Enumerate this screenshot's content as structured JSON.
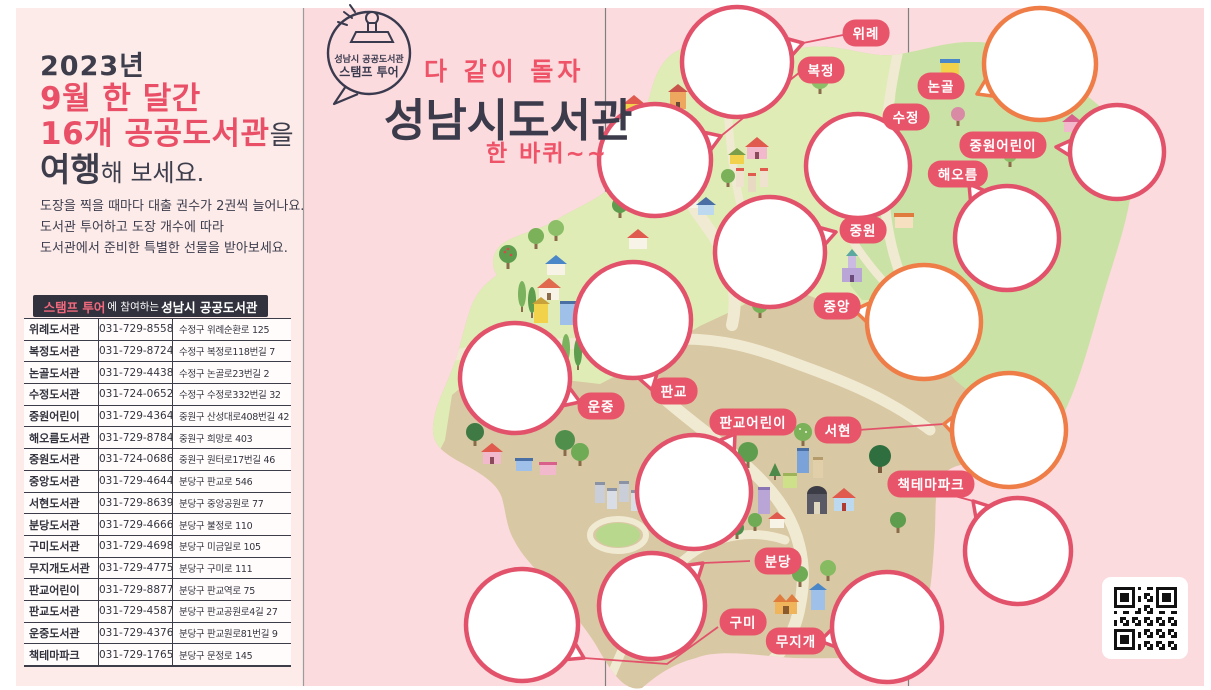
{
  "brochure": {
    "badge": {
      "org": "성남시 공공도서관",
      "tour": "스탬프 투어"
    },
    "tagline": "다 같이 돌자",
    "title": "성남시도서관",
    "subtitle": "한 바퀴~~"
  },
  "left_panel": {
    "heading": {
      "year": "2023년",
      "line2": "9월 한 달간",
      "line3_accent": "16개 공공도서관",
      "line3_suffix": "을",
      "line4_strong": "여행",
      "line4_suffix": "해 보세요."
    },
    "description_lines": [
      "도장을 찍을 때마다 대출 권수가 2권씩 늘어나요.",
      "도서관 투어하고 도장 개수에 따라",
      "도서관에서 준비한 특별한 선물을 받아보세요."
    ],
    "table": {
      "title_accent": "스탬프 투어",
      "title_middle": "에 참여하는",
      "title_strong": "성남시 공공도서관",
      "rows": [
        {
          "name": "위례도서관",
          "phone": "031-729-8558",
          "address": "수정구 위례순환로 125"
        },
        {
          "name": "복정도서관",
          "phone": "031-729-8724",
          "address": "수정구 복정로118번길 7"
        },
        {
          "name": "논골도서관",
          "phone": "031-729-4438",
          "address": "수정구 논골로23번길 2"
        },
        {
          "name": "수정도서관",
          "phone": "031-724-0652",
          "address": "수정구 수정로332번길 32"
        },
        {
          "name": "중원어린이",
          "phone": "031-729-4364",
          "address": "중원구 산성대로408번길 42"
        },
        {
          "name": "해오름도서관",
          "phone": "031-729-8784",
          "address": "중원구 희망로 403"
        },
        {
          "name": "중원도서관",
          "phone": "031-724-0686",
          "address": "중원구 원터로17번길 46"
        },
        {
          "name": "중앙도서관",
          "phone": "031-729-4644",
          "address": "분당구 판교로 546"
        },
        {
          "name": "서현도서관",
          "phone": "031-729-8639",
          "address": "분당구 중앙공원로 77"
        },
        {
          "name": "분당도서관",
          "phone": "031-729-4666",
          "address": "분당구 불정로 110"
        },
        {
          "name": "구미도서관",
          "phone": "031-729-4698",
          "address": "분당구 미금일로 105"
        },
        {
          "name": "무지개도서관",
          "phone": "031-729-4775",
          "address": "분당구 구미로 111"
        },
        {
          "name": "판교어린이",
          "phone": "031-729-8877",
          "address": "분당구 판교역로 75"
        },
        {
          "name": "판교도서관",
          "phone": "031-729-4587",
          "address": "분당구 판교공원로4길 27"
        },
        {
          "name": "운중도서관",
          "phone": "031-729-4376",
          "address": "분당구 판교원로81번길 9"
        },
        {
          "name": "책테마파크",
          "phone": "031-729-1765",
          "address": "분당구 문정로 145"
        }
      ]
    }
  },
  "map": {
    "labels": [
      {
        "id": "wirye",
        "text": "위례"
      },
      {
        "id": "bokjeong",
        "text": "복정"
      },
      {
        "id": "nongol",
        "text": "논골"
      },
      {
        "id": "sujeong",
        "text": "수정"
      },
      {
        "id": "jungwon-child",
        "text": "중원어린이"
      },
      {
        "id": "haeoreum",
        "text": "해오름"
      },
      {
        "id": "jungwon",
        "text": "중원"
      },
      {
        "id": "jungang",
        "text": "중앙"
      },
      {
        "id": "pangyo",
        "text": "판교"
      },
      {
        "id": "unjung",
        "text": "운중"
      },
      {
        "id": "pangyo-child",
        "text": "판교어린이"
      },
      {
        "id": "seohyeon",
        "text": "서현"
      },
      {
        "id": "book-theme-park",
        "text": "책테마파크"
      },
      {
        "id": "bundang",
        "text": "분당"
      },
      {
        "id": "gumi",
        "text": "구미"
      },
      {
        "id": "mujigae",
        "text": "무지개"
      }
    ],
    "stamp_circle_count": 16
  },
  "colors": {
    "accent_pink": "#e8556a",
    "accent_orange": "#ee7d48",
    "heading_red": "#e94f66",
    "dark_text": "#3d3d4c",
    "panel_left_bg": "#fcebe9",
    "panel_right_bg": "#fbdbde",
    "map_green_light": "#dfecb6",
    "map_green_deep": "#cbe2a6",
    "map_tan": "#d8c8a3",
    "road": "#f1ead2",
    "table_header_bg": "#32323e"
  }
}
